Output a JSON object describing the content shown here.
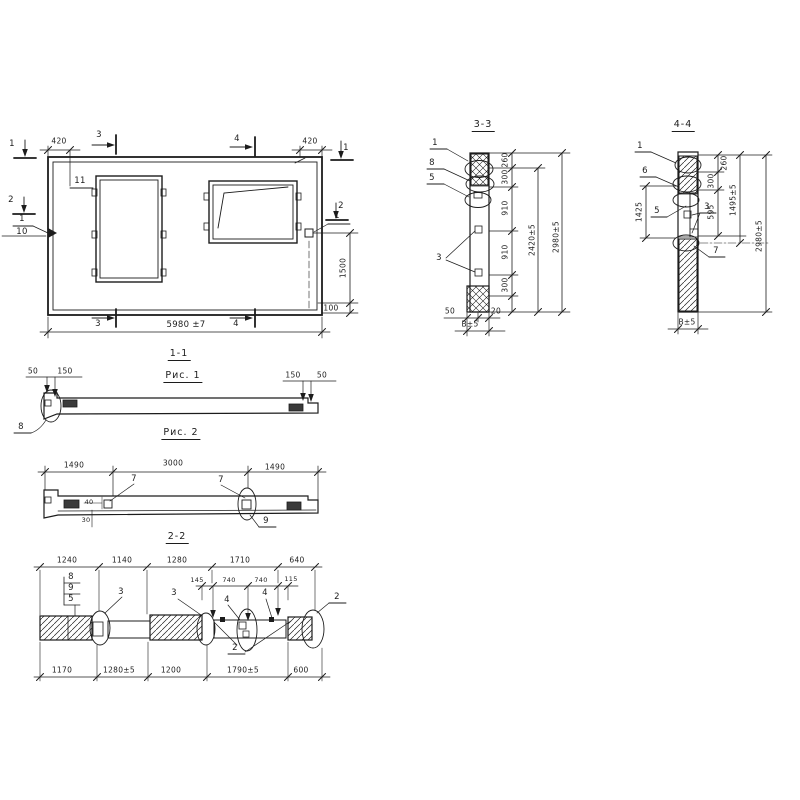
{
  "main_view": {
    "marker_1_left": "1",
    "marker_2_left": "2",
    "marker_1_right": "1",
    "marker_2_right": "2",
    "marker_3_top": "3",
    "marker_3_bottom": "3",
    "marker_4_top": "4",
    "marker_4_bottom": "4",
    "dim_420_left": "420",
    "dim_420_right": "420",
    "dim_overall": "5980 ±7",
    "dim_1500": "1500",
    "dim_100": "100",
    "label_11": "11",
    "label_1_num": "1",
    "label_1_den": "10",
    "label_1_right": "1"
  },
  "section_3_3": {
    "title": "3-3",
    "label_1": "1",
    "label_8": "8",
    "label_5": "5",
    "label_3": "3",
    "dim_260": "260",
    "dim_300_top": "300",
    "dim_910_top": "910",
    "dim_910_bottom": "910",
    "dim_300_bottom": "300",
    "dim_2420": "2420±5",
    "dim_2980": "2980±5",
    "dim_50": "50",
    "dim_20": "20",
    "dim_thickness": "В±5"
  },
  "section_4_4": {
    "title": "4-4",
    "label_1": "1",
    "label_6": "6",
    "label_5": "5",
    "label_3": "3",
    "label_7": "7",
    "dim_1425": "1425",
    "dim_260": "260",
    "dim_300": "300",
    "dim_595": "595",
    "dim_1495": "1495±5",
    "dim_2980": "2980±5",
    "dim_thickness": "В±5"
  },
  "section_1_1": {
    "title": "1-1",
    "caption": "Рис. 1",
    "dim_50_left": "50",
    "dim_150_left": "150",
    "dim_150_right": "150",
    "dim_50_right": "50",
    "label_8": "8"
  },
  "fig_2": {
    "caption": "Рис. 2",
    "dim_1490_left": "1490",
    "dim_3000": "3000",
    "dim_1490_right": "1490",
    "dim_40": "40",
    "dim_30": "30",
    "label_7_left": "7",
    "label_7_right": "7",
    "label_9": "9"
  },
  "section_2_2": {
    "title": "2-2",
    "top_dims": [
      "1240",
      "1140",
      "1280",
      "1710",
      "640"
    ],
    "mid_dims": [
      "145",
      "740",
      "740",
      "115"
    ],
    "bottom_dims": [
      "1170",
      "1280±5",
      "1200",
      "1790±5",
      "600"
    ],
    "label_8": "8",
    "label_9": "9",
    "label_5": "5",
    "label_3_left": "3",
    "label_3_right": "3",
    "label_4_left": "4",
    "label_4_right": "4",
    "label_2_bottom": "2",
    "label_2_right": "2"
  }
}
